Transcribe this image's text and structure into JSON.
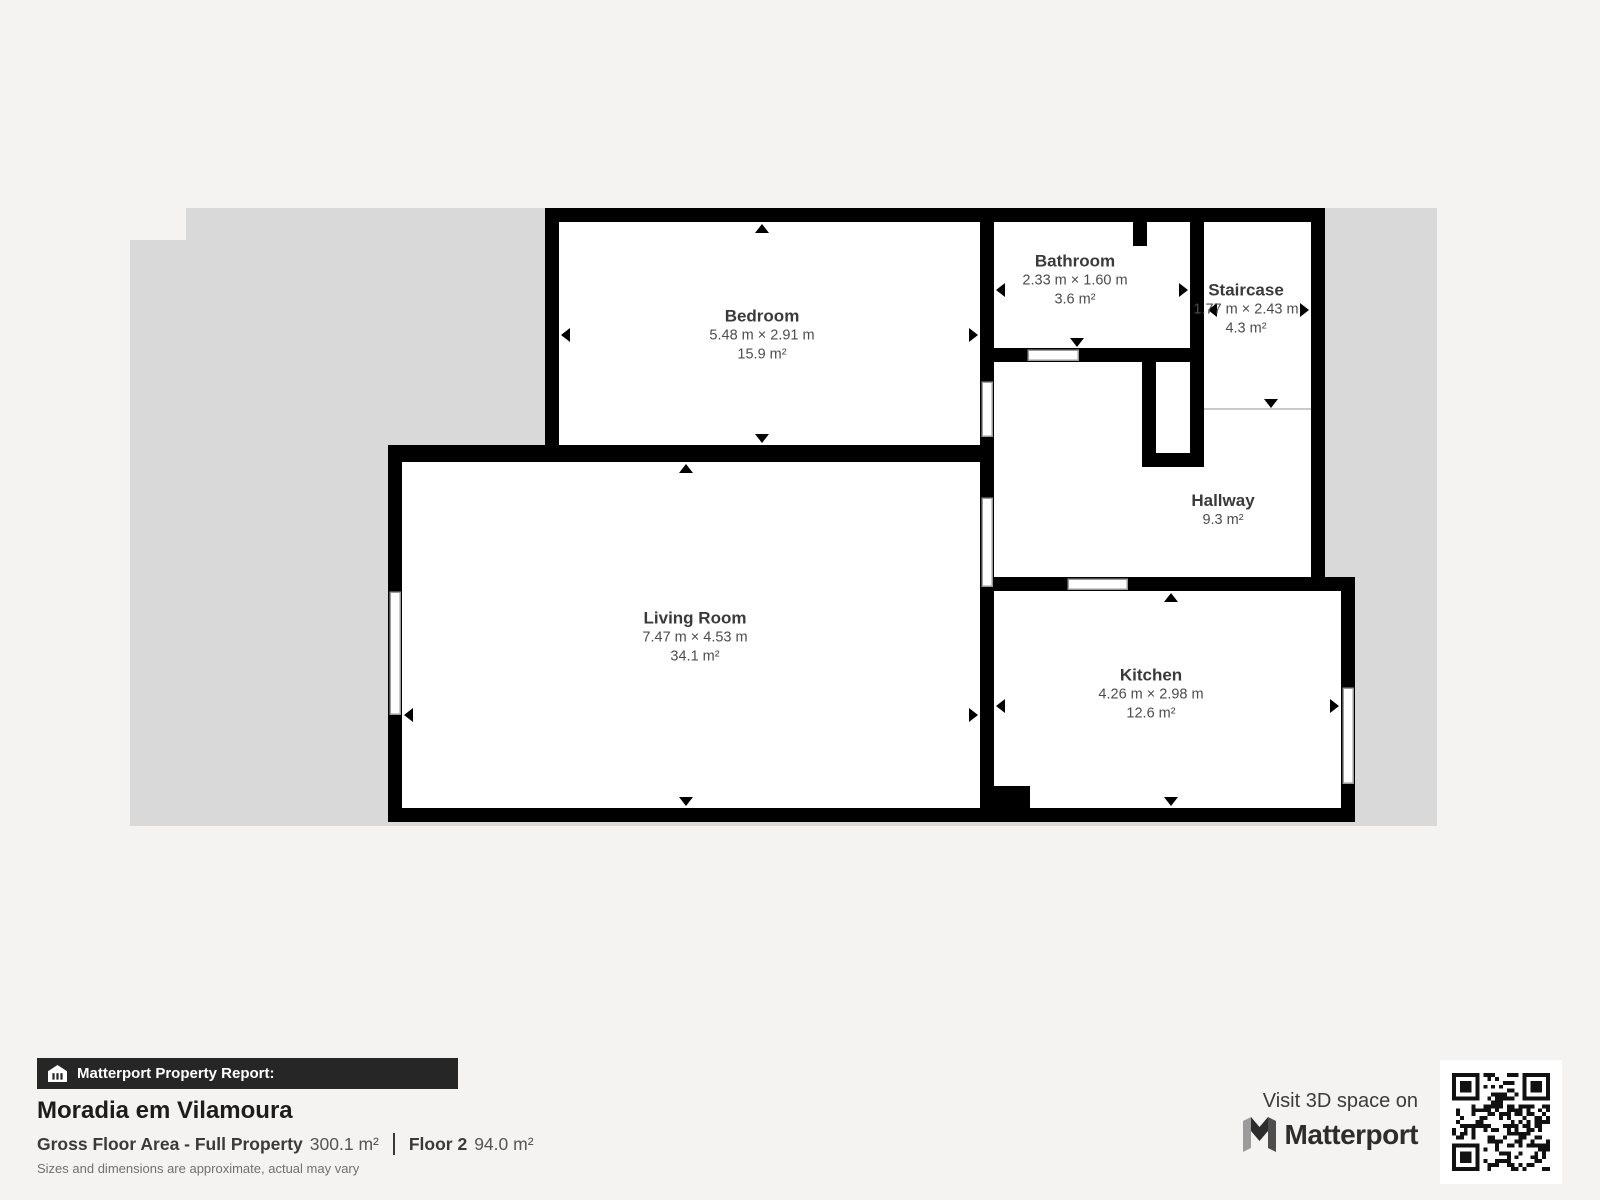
{
  "plan": {
    "rooms": [
      {
        "id": "bedroom",
        "name": "Bedroom",
        "dimensions": "5.48 m × 2.91 m",
        "area": "15.9 m²"
      },
      {
        "id": "bathroom",
        "name": "Bathroom",
        "dimensions": "2.33 m × 1.60 m",
        "area": "3.6 m²"
      },
      {
        "id": "staircase",
        "name": "Staircase",
        "dimensions": "1.77 m × 2.43 m",
        "area": "4.3 m²"
      },
      {
        "id": "hallway",
        "name": "Hallway",
        "dimensions": "",
        "area": "9.3 m²"
      },
      {
        "id": "living_room",
        "name": "Living Room",
        "dimensions": "7.47 m × 4.53 m",
        "area": "34.1 m²"
      },
      {
        "id": "kitchen",
        "name": "Kitchen",
        "dimensions": "4.26 m × 2.98 m",
        "area": "12.6 m²"
      }
    ],
    "colors": {
      "backdrop": "#d9d9d9",
      "wall": "#000000",
      "room_fill": "#ffffff",
      "page_background": "#f4f3f1",
      "header_bar": "#262626"
    }
  },
  "report": {
    "header": "Matterport Property Report:",
    "property_name": "Moradia em Vilamoura",
    "gross_label": "Gross Floor Area - Full Property",
    "gross_value": "300.1 m²",
    "floor_label": "Floor 2",
    "floor_value": "94.0 m²",
    "disclaimer": "Sizes and dimensions are approximate, actual may vary"
  },
  "footer_right": {
    "visit_text": "Visit 3D space on",
    "brand": "Matterport"
  }
}
